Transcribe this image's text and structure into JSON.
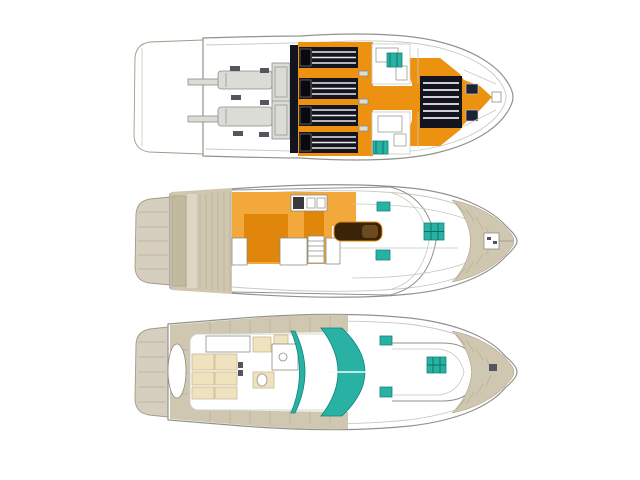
{
  "image": {
    "kind": "yacht-deck-plan-drawing",
    "background": "#FFFFFF"
  },
  "colors": {
    "background": "#FFFFFF",
    "outline": "#92928C",
    "outline_light": "#C8C8C2",
    "platform_tan": "#D6CFBF",
    "teak": "#CFC7B0",
    "teak_dark": "#C3B99F",
    "teak_light": "#DDD6C4",
    "teak_line": "#B9AF96",
    "teak_edge": "#A39A86",
    "deck_orange": "#EC9110",
    "galley_orange": "#F3A83C",
    "furniture_orange": "#DF860B",
    "teal": "#29B2A3",
    "teal_dark": "#0E877B",
    "teal_grid": "#0B6E65",
    "panel_black": "#14141E",
    "slat_line": "#E8E8EE",
    "navy_hatch": "#1D2336",
    "grey_item": "#DCDCD7",
    "grey_item_edge": "#8D8D87",
    "dark_mark": "#55555F",
    "bed_cream": "#EFE2BE",
    "bed_cream_edge": "#C9B98F",
    "sofa_brown": "#3A2408",
    "sofa_brown_light": "#6B4A22"
  },
  "views": [
    {
      "id": "flybridge-deck",
      "position": "top",
      "features": [
        "swim-platform",
        "davit-arms",
        "sun-loungers",
        "aft-bench",
        "roof-hatch-panels",
        "helm-consoles",
        "helm-seats",
        "bow-sunroof-panel",
        "deck-hatches"
      ]
    },
    {
      "id": "main-deck",
      "position": "middle",
      "features": [
        "swim-platform",
        "cockpit-teak-deck",
        "galley-area",
        "galley-appliances",
        "salon-sofa",
        "companionway-stairs",
        "salon-cabinets",
        "windshield",
        "foredeck-hatches",
        "anchor-windlass",
        "bow-teak-deck"
      ]
    },
    {
      "id": "lower-deck",
      "position": "bottom",
      "features": [
        "swim-platform",
        "transom-deck",
        "aft-cabin-berth",
        "berth-cushions",
        "toilet",
        "sink",
        "curved-bulkheads",
        "forward-berth",
        "deck-hatches",
        "bow-teak-deck"
      ]
    }
  ]
}
